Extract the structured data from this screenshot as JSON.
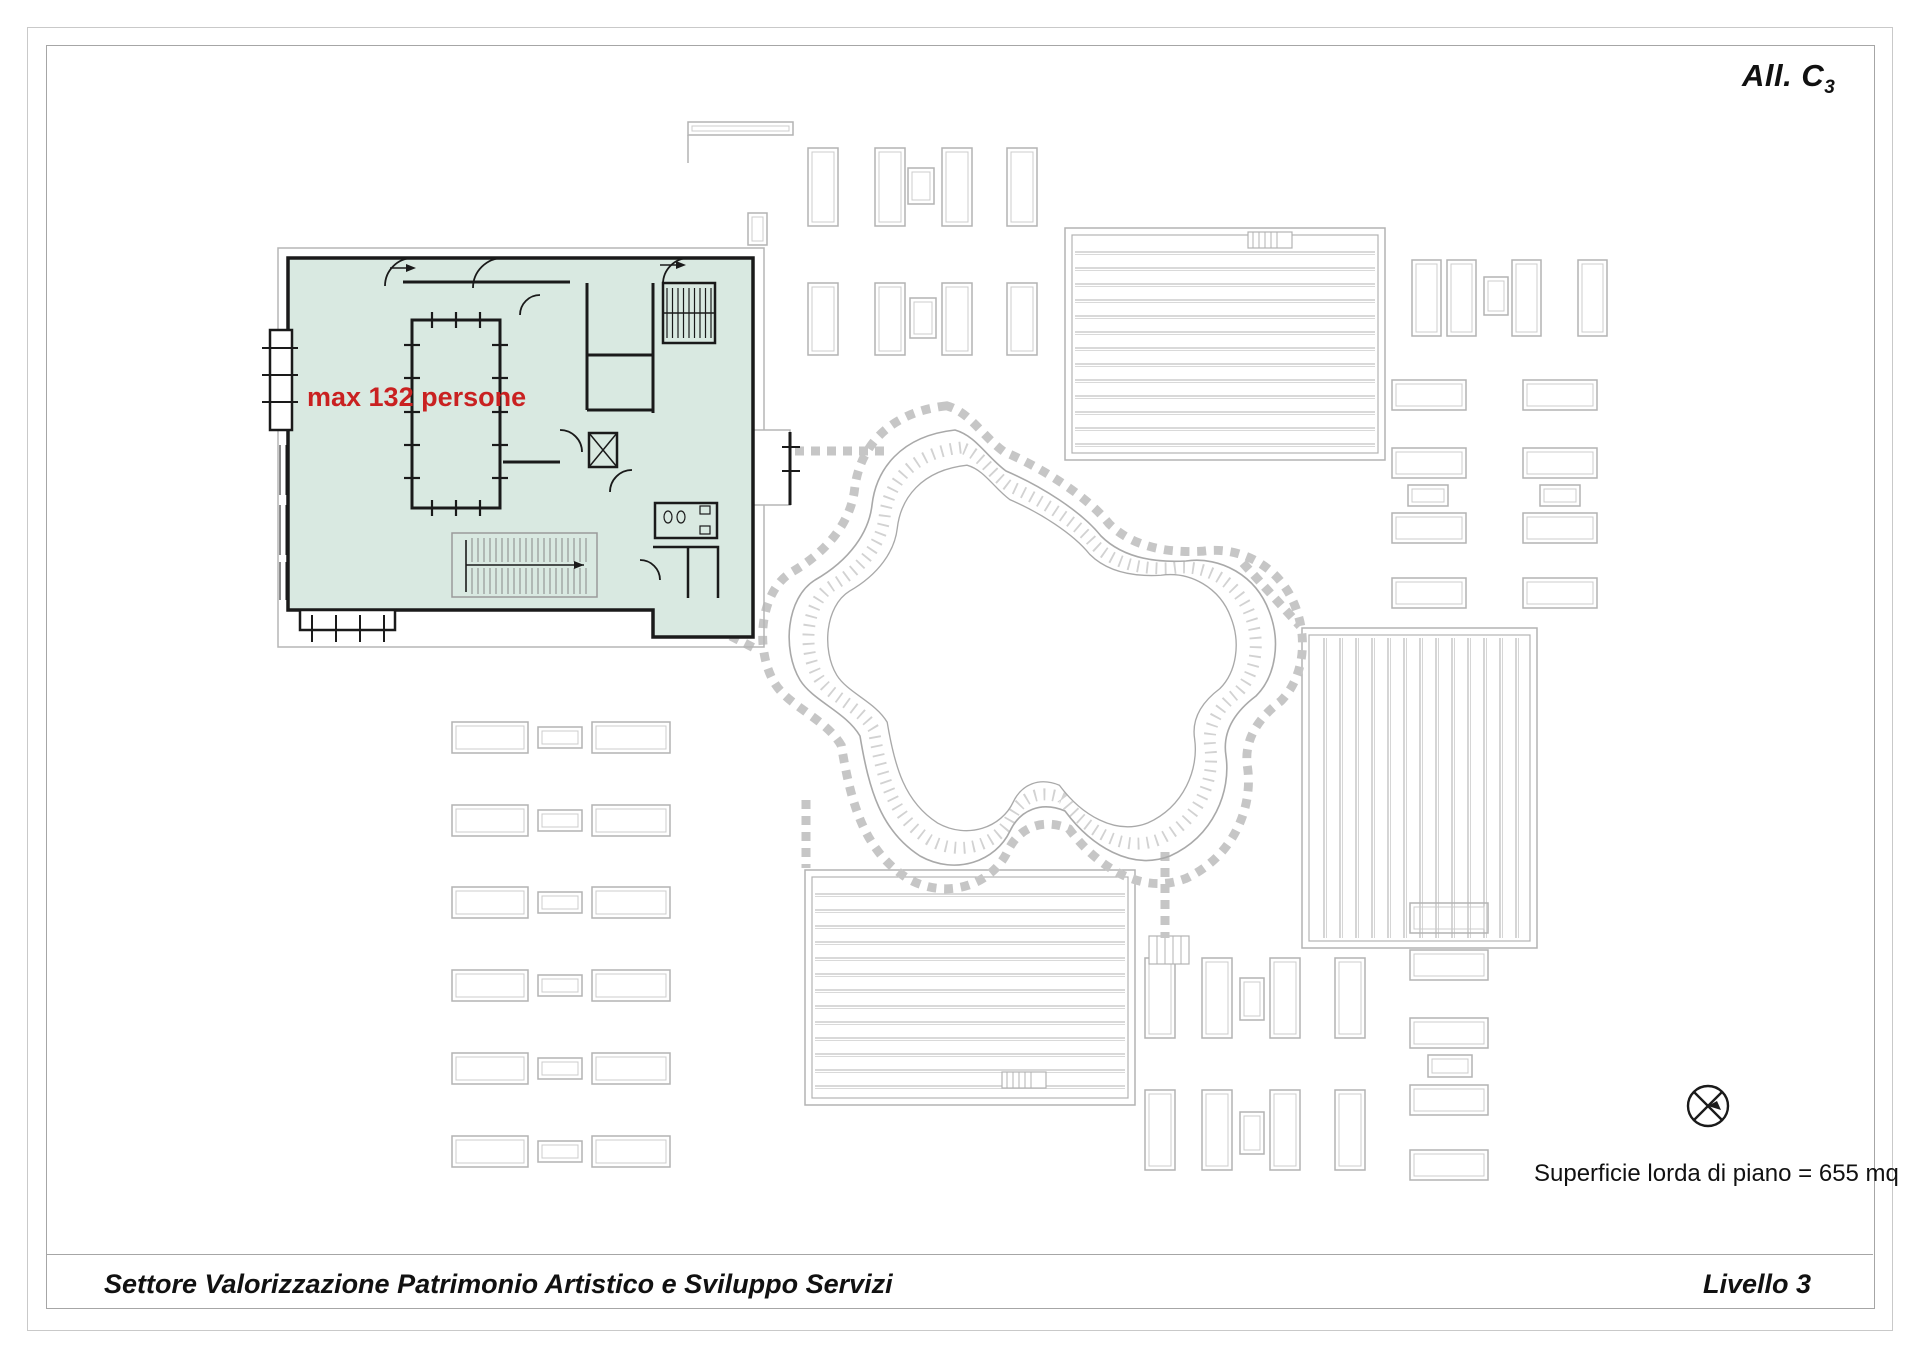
{
  "header": {
    "attachment_label": "All. C",
    "attachment_subscript": "3"
  },
  "plan": {
    "capacity_label": "max 132 persone",
    "highlight_color": "#d9e9e1",
    "capacity_text_color": "#c92121",
    "wall_color": "#1a1a1a",
    "background_drawing_color": "#b3b3b3"
  },
  "notes": {
    "area_note": "Superficie lorda di piano = 655 mq"
  },
  "footer": {
    "department": "Settore Valorizzazione Patrimonio Artistico e Sviluppo Servizi",
    "level_label": "Livello 3"
  },
  "icons": {
    "north_symbol": "north-arrow-icon"
  }
}
